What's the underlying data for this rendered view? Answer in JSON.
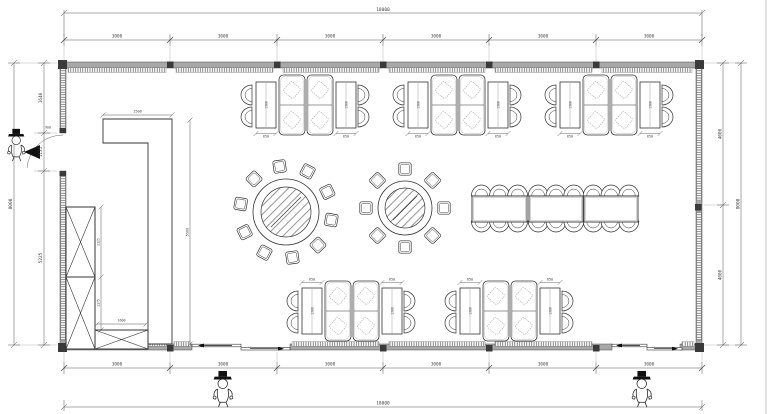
{
  "drawing": {
    "dims": {
      "overall_width": "18000",
      "overall_height": "8000",
      "top_segments": [
        "3000",
        "3000",
        "3000",
        "3000",
        "3000",
        "3000"
      ],
      "bottom_segments": [
        "3000",
        "3000",
        "3000",
        "3000",
        "3000",
        "3000"
      ],
      "left_segments": [
        "1640",
        "1135",
        "5225"
      ],
      "right_segments": [
        "4000",
        "4000"
      ],
      "booth_table_width": "650",
      "booth_table_length": "1300",
      "counter_width": "1500",
      "counter_length": "5500",
      "cabinet_upper_height": "2125",
      "cabinet_lower_height": "1175",
      "low_cabinet_length": "1600",
      "door_leaf_width": "900"
    }
  }
}
